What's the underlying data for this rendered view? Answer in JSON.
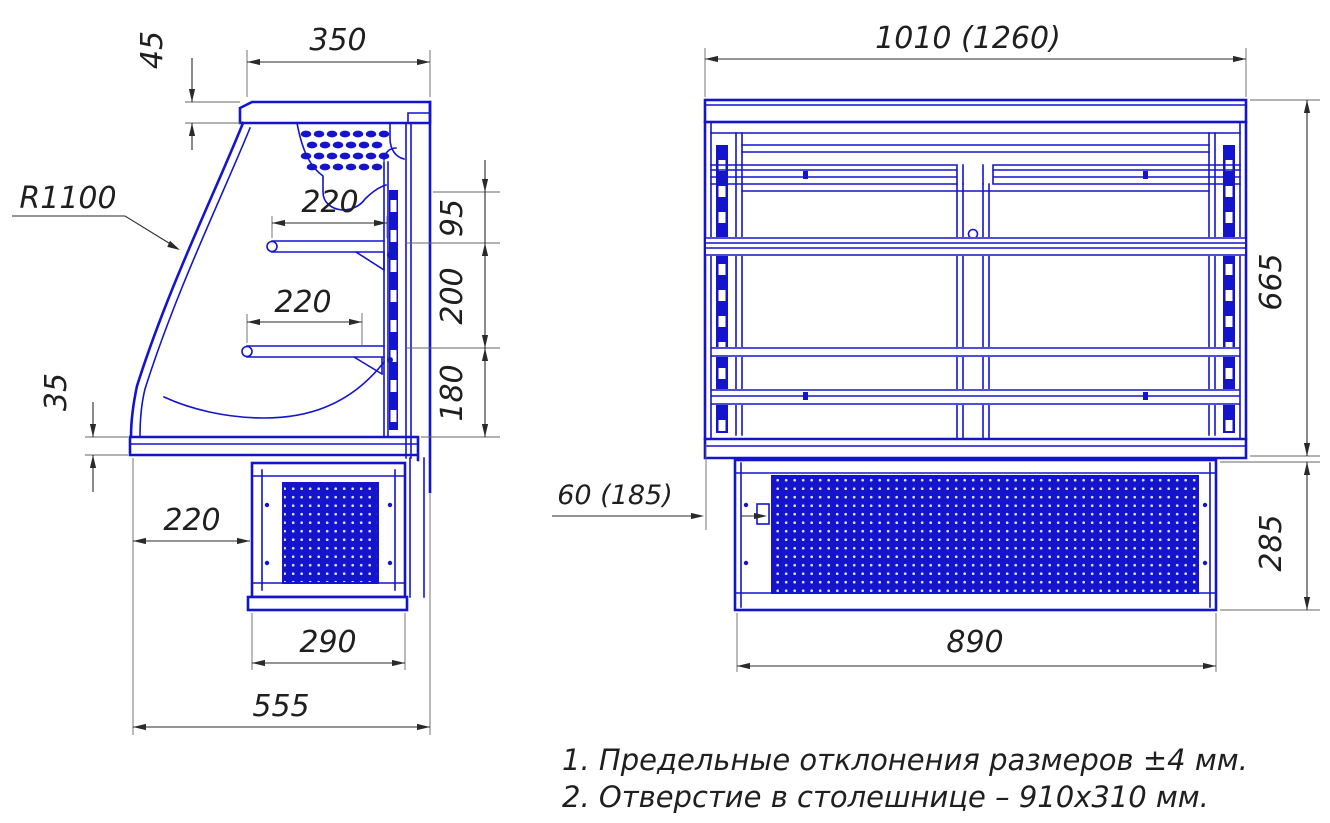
{
  "drawing": {
    "type": "refrigerated-display-case-dimension-drawing",
    "colors": {
      "line_blue": "#1414CC",
      "dim_dark": "#2a2a2a",
      "background": "#ffffff"
    }
  },
  "dimensions": {
    "side": {
      "canopy_width": "350",
      "canopy_height": "45",
      "glass_radius": "R1100",
      "upper_shelf_depth": "220",
      "lower_shelf_depth": "220",
      "gap_canopy_to_upper_shelf": "95",
      "gap_upper_to_lower_shelf": "200",
      "gap_lower_shelf_to_deck": "180",
      "deck_band_height": "35",
      "base_setback": "220",
      "base_depth": "290",
      "overall_depth": "555"
    },
    "front": {
      "overall_width": "1010 (1260)",
      "body_height": "665",
      "base_height": "285",
      "base_side_inset": "60 (185)",
      "base_width": "890"
    }
  },
  "notes": [
    "1. Предельные отклонения размеров ±4 мм.",
    "2. Отверстие в столешнице – 910x310 мм."
  ]
}
